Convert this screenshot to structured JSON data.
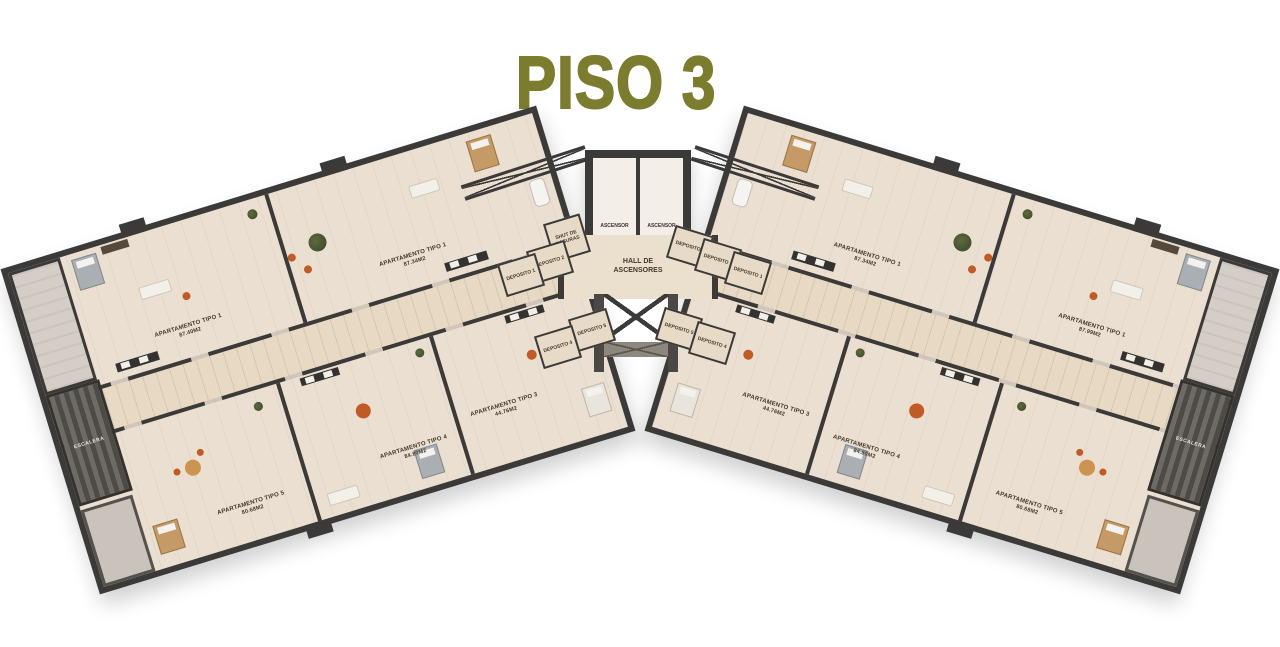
{
  "title": "PISO 3",
  "colors": {
    "title": "#7c7c2e",
    "wall": "#3b3a39",
    "floor": "#eadfd0",
    "corridor": "#e7d9c3",
    "accent_orange": "#c05a26",
    "plant_green": "#45522e",
    "background": "#ffffff"
  },
  "core": {
    "elevators": [
      {
        "label": "ASCENSOR"
      },
      {
        "label": "ASCENSOR"
      }
    ],
    "hall": "HALL DE ASCENSORES",
    "shut": "SHUT DE BASURAS"
  },
  "left_wing": {
    "depositos": [
      "DEPOSITO 1",
      "DEPOSITO 2",
      "DEPOSITO 4",
      "DEPOSITO 5"
    ],
    "apartments": [
      {
        "name": "APARTAMENTO TIPO 1",
        "area": "87.34M2"
      },
      {
        "name": "APARTAMENTO TIPO 1",
        "area": "87.40M2"
      },
      {
        "name": "APARTAMENTO TIPO 3",
        "area": "44.76M2"
      },
      {
        "name": "APARTAMENTO TIPO 4",
        "area": "84.80M2"
      },
      {
        "name": "APARTAMENTO TIPO 5",
        "area": "80.68M2"
      }
    ],
    "stair_label": "ESCALERA"
  },
  "right_wing": {
    "depositos": [
      "DEPOSITO 1",
      "DEPOSITO 2",
      "DEPOSITO 3",
      "DEPOSITO 4",
      "DEPOSITO 5"
    ],
    "apartments": [
      {
        "name": "APARTAMENTO TIPO 1",
        "area": "87.34M2"
      },
      {
        "name": "APARTAMENTO TIPO 1",
        "area": "87.99M2"
      },
      {
        "name": "APARTAMENTO TIPO 3",
        "area": "44.76M2"
      },
      {
        "name": "APARTAMENTO TIPO 4",
        "area": "84.80M2"
      },
      {
        "name": "APARTAMENTO TIPO 5",
        "area": "80.68M2"
      }
    ],
    "stair_label": "ESCALERA"
  }
}
